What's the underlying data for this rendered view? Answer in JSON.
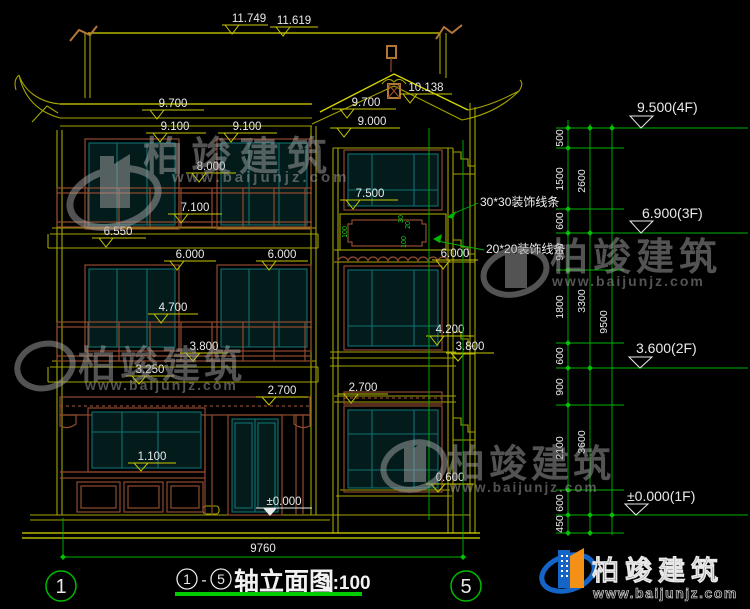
{
  "drawing": {
    "type": "elevation",
    "marks": {
      "m11749": "11.749",
      "m11619": "11.619",
      "m10138": "10.138",
      "m9700a": "9.700",
      "m9700b": "9.700",
      "m9100a": "9.100",
      "m9100b": "9.100",
      "m9000": "9.000",
      "m8000": "8.000",
      "m7500": "7.500",
      "m7100": "7.100",
      "m6550": "6.550",
      "m6000a": "6.000",
      "m6000b": "6.000",
      "m6000c": "6.000",
      "m4700": "4.700",
      "m4200": "4.200",
      "m3800a": "3.800",
      "m3800b": "3.800",
      "m3250": "3.250",
      "m2700a": "2.700",
      "m2700b": "2.700",
      "m1100": "1.100",
      "m0600": "0.600",
      "m0000": "±0.000"
    },
    "levels": {
      "f4": "9.500(4F)",
      "f3": "6.900(3F)",
      "f2": "3.600(2F)",
      "f1": "±0.000(1F)"
    },
    "chain": {
      "inner": [
        "500",
        "1500",
        "600",
        "900",
        "1800",
        "600",
        "900",
        "2100",
        "600",
        "450"
      ],
      "mid": [
        "2600",
        "3300",
        "3600"
      ],
      "total": "9500"
    },
    "annotations": {
      "m30": "30*30装饰线条",
      "m20": "20*20装饰线条"
    },
    "panel_dims": [
      "100",
      "30",
      "20",
      "100"
    ]
  },
  "bottom": {
    "overall_width": "9760",
    "axis_left": "1",
    "axis_right": "5",
    "title_c1": "1",
    "title_dash": "-",
    "title_c5": "5",
    "title": "轴立面图",
    "scale": "1:100"
  },
  "watermark": {
    "brand": "柏竣建筑",
    "url": "www.baijunjz.com"
  },
  "logo": {
    "brand": "柏竣建筑",
    "url": "www.baijunjz.com"
  },
  "colors": {
    "background": "#000000",
    "linework_yellow": "#a3a300",
    "window_teal": "#107070",
    "detail_brown": "#8f4a2e",
    "dimension_green": "#00b400",
    "text_white": "#e9e9e9",
    "logo_blue": "#1565c8",
    "logo_orange": "#f59016"
  }
}
